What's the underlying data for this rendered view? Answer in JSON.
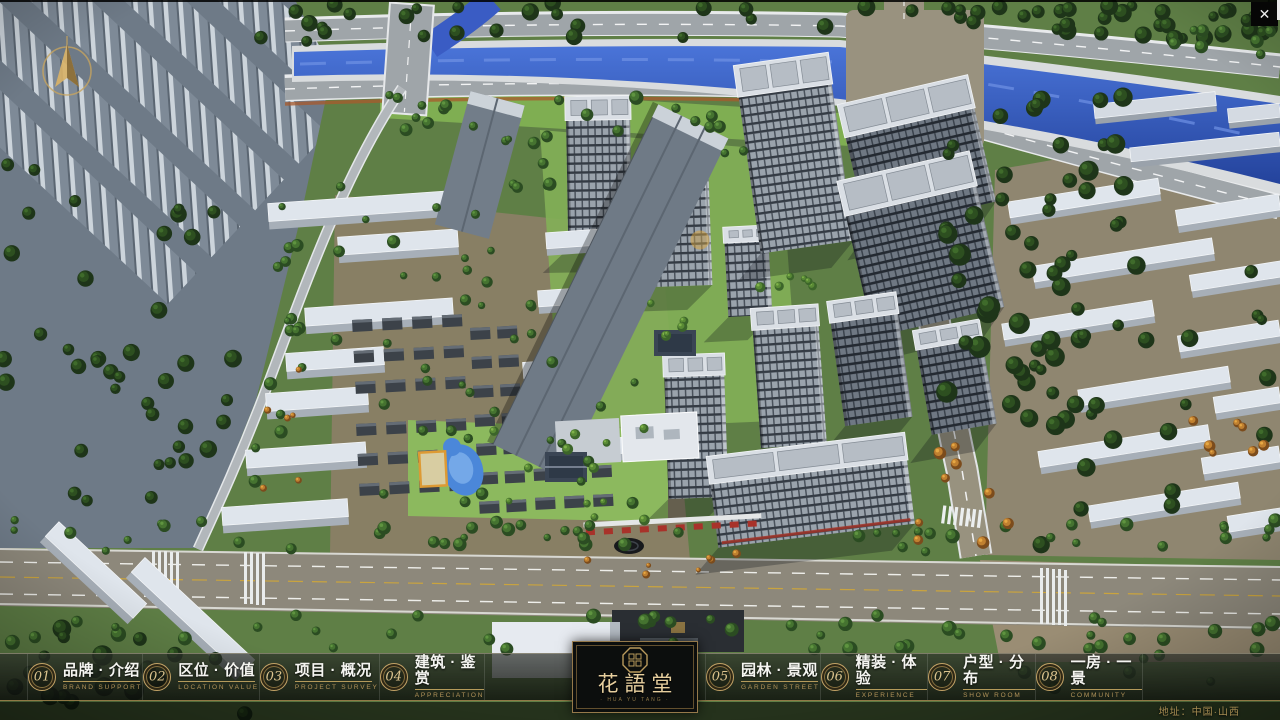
{
  "chrome": {
    "close_glyph": "✕"
  },
  "nav": {
    "items": [
      {
        "num": "01",
        "cn": "品牌 · 介绍",
        "en": "BRAND SUPPORT"
      },
      {
        "num": "02",
        "cn": "区位 · 价值",
        "en": "LOCATION VALUE"
      },
      {
        "num": "03",
        "cn": "项目 · 概况",
        "en": "PROJECT SURVEY"
      },
      {
        "num": "04",
        "cn": "建筑 · 鉴赏",
        "en": "APPRECIATION"
      },
      {
        "num": "05",
        "cn": "园林 · 景观",
        "en": "GARDEN STREET"
      },
      {
        "num": "06",
        "cn": "精装 · 体验",
        "en": "EXPERIENCE"
      },
      {
        "num": "07",
        "cn": "户型 · 分布",
        "en": "SHOW ROOM"
      },
      {
        "num": "08",
        "cn": "一房 · 一景",
        "en": "COMMUNITY"
      }
    ]
  },
  "logo": {
    "title": "花語堂",
    "subtitle": "· HUA YU TANG ·"
  },
  "footer": {
    "address": "地址：中国·山西"
  },
  "colors": {
    "gold": "#c2a266",
    "bar_bg": "#14160f",
    "river": "#3a62cf",
    "grass": "#7fab55"
  }
}
